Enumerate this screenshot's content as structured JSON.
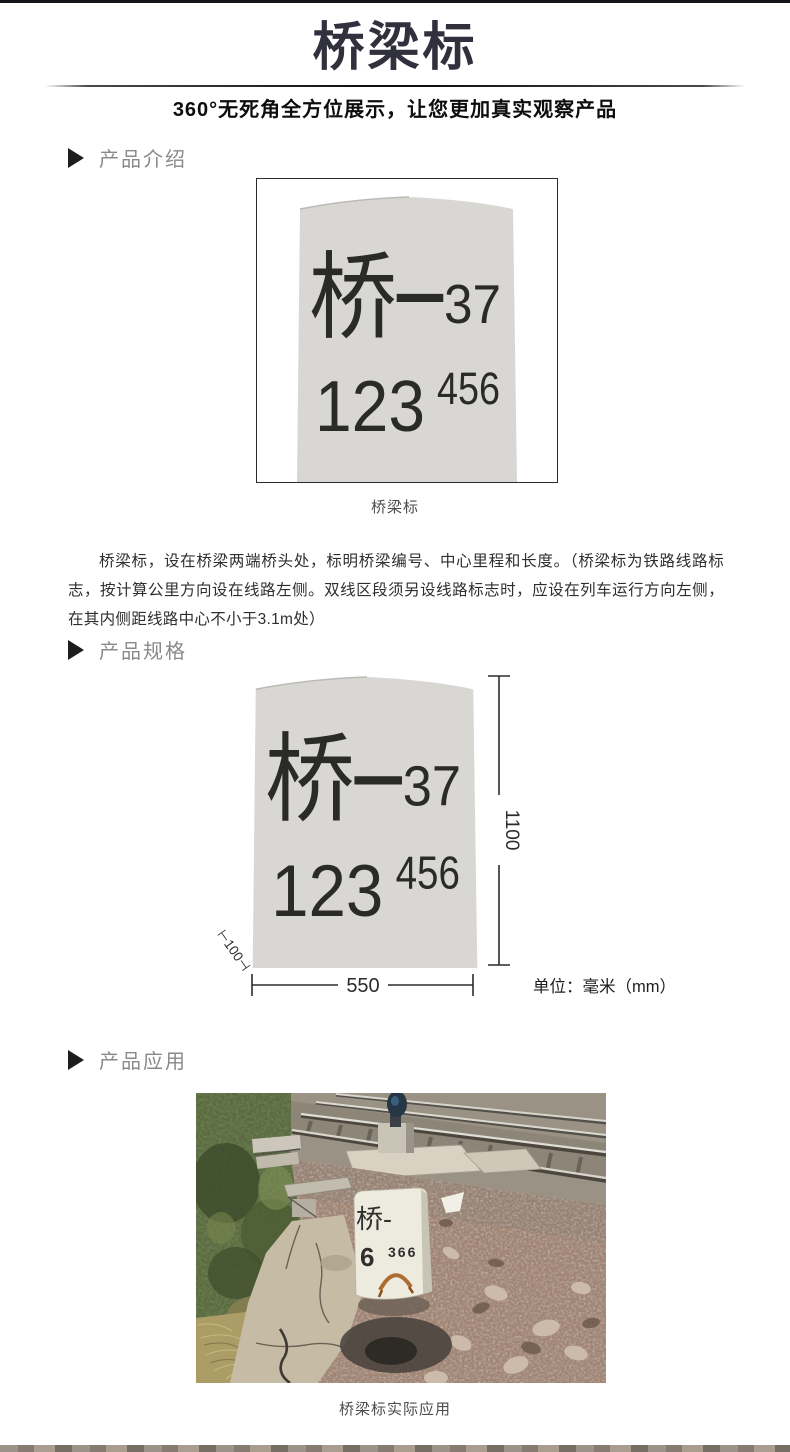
{
  "header": {
    "title": "桥梁标",
    "subtitle": "360°无死角全方位展示，让您更加真实观察产品"
  },
  "sections": {
    "intro_label": "产品介绍",
    "spec_label": "产品规格",
    "app_label": "产品应用"
  },
  "marker_sign": {
    "line1_char": "桥",
    "line1_dash": "—",
    "line1_num": "37",
    "line2_big": "123",
    "line2_small": "456"
  },
  "figure1": {
    "caption": "桥梁标"
  },
  "intro_text": "桥梁标，设在桥梁两端桥头处，标明桥梁编号、中心里程和长度。（桥梁标为铁路线路标志，按计算公里方向设在线路左侧。双线区段须另设线路标志时，应设在列车运行方向左侧，在其内侧距线路中心不小于3.1m处）",
  "spec_figure": {
    "height_label": "1100",
    "width_label": "550",
    "depth_label": "⊢100⊣",
    "unit_label": "单位：毫米（mm）"
  },
  "photo": {
    "caption": "桥梁标实际应用",
    "stone_line1": "桥-",
    "stone_line2_big": "6",
    "stone_line2_small": "366"
  },
  "colors": {
    "title_ink": "#31313d",
    "section_label_gray": "#8a8a8a",
    "marker_stone_gray": "#d9d7d3",
    "sign_ink": "#2a2a28",
    "dimension_ink": "#2b2b2b",
    "gravel_pink": "#a18575",
    "vegetation_green": "#59663d",
    "rust_stain": "#a55f1e"
  }
}
